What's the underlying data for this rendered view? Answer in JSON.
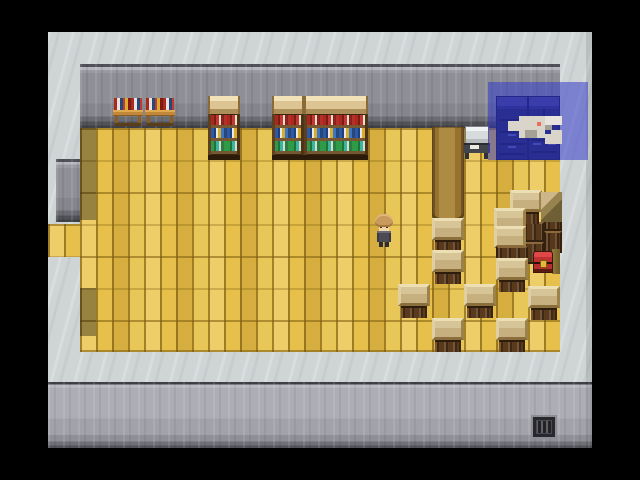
{
  "scene": {
    "title": "rpg-interior-library-storeroom",
    "viewport": {
      "x": 48,
      "y": 32,
      "w": 544,
      "h": 416
    },
    "palette": {
      "letterbox": "#000000",
      "ceiling": "#cfd4d5",
      "wall": "#96979e",
      "lower_wall": "#aaabb2",
      "floor": "#e6c04a",
      "selection_overlay": "rgba(47,53,201,0.52)",
      "crate_top": "#cdb88c",
      "crate_front": "#5a3a1c",
      "chest_red": "#c03232",
      "cabinet_navy": "#232759",
      "minimap_floor": "#d9d5cb",
      "player_marker": "#ef6e5a"
    },
    "regions": {
      "ceiling": [
        0,
        0,
        544,
        416
      ],
      "top_wall": [
        32,
        32,
        480,
        64
      ],
      "floor": [
        32,
        96,
        480,
        224
      ],
      "floor_edge": [
        32,
        318,
        480,
        2
      ],
      "alcove_wall": [
        8,
        127,
        24,
        63
      ],
      "alcove_floor": [
        0,
        192,
        32,
        33
      ],
      "lower_wall": [
        0,
        350,
        544,
        66
      ],
      "right_edge_shade": [
        538,
        0,
        6,
        416
      ],
      "shadows": [
        [
          32,
          96,
          16,
          92
        ],
        [
          32,
          256,
          16,
          48
        ]
      ]
    },
    "furniture": {
      "book_carts": [
        [
          65,
          66
        ],
        [
          97,
          66
        ]
      ],
      "bookshelves": [
        {
          "x": 160,
          "y": 64,
          "w": 32,
          "rows": [
            "red",
            "blue",
            "green"
          ]
        },
        {
          "x": 224,
          "y": 64,
          "w": 32,
          "rows": [
            "red",
            "blue",
            "green"
          ]
        },
        {
          "x": 256,
          "y": 64,
          "w": 64,
          "rows": [
            "red",
            "blue",
            "green"
          ]
        }
      ],
      "cabinets": {
        "x": 448,
        "y": 64,
        "w": 64,
        "h": 64
      },
      "counter": {
        "x": 415,
        "y": 94
      },
      "long_table": [
        384,
        95,
        32,
        96
      ],
      "grate": [
        485,
        385,
        22,
        20
      ]
    },
    "sprites": [
      [
        "dark",
        496,
        176,
        18,
        23
      ],
      [
        "dark",
        496,
        199,
        18,
        22
      ],
      [
        "dark",
        464,
        190,
        32,
        20
      ],
      [
        "dark",
        464,
        210,
        32,
        22
      ],
      [
        "crate",
        462,
        158
      ],
      [
        "crate",
        446,
        176
      ],
      [
        "crate",
        446,
        194
      ],
      [
        "dark",
        448,
        214,
        32,
        14
      ],
      [
        "wedge",
        493,
        160,
        21,
        30
      ],
      [
        "crate",
        384,
        186
      ],
      [
        "crate",
        384,
        218
      ],
      [
        "crate",
        448,
        226
      ],
      [
        "crate",
        350,
        252
      ],
      [
        "crate",
        416,
        252
      ],
      [
        "crate",
        480,
        254
      ],
      [
        "crate",
        384,
        286
      ],
      [
        "crate",
        448,
        286
      ],
      [
        "gold",
        504,
        217,
        8,
        25
      ],
      [
        "chest",
        485,
        219
      ]
    ],
    "player": {
      "x": 326,
      "y": 182,
      "facing": "down"
    },
    "map_overlay": {
      "rect": [
        440,
        50,
        100,
        78
      ],
      "minimap_origin": [
        459,
        82
      ],
      "minimap_blocks": [
        [
          12,
          2,
          26,
          22,
          "pale"
        ],
        [
          1,
          7,
          11,
          10,
          "pale"
        ],
        [
          38,
          2,
          17,
          9,
          "lighter"
        ],
        [
          44,
          16,
          11,
          14,
          "pale"
        ],
        [
          38,
          20,
          6,
          10,
          "pale"
        ],
        [
          38,
          11,
          7,
          5,
          "gray"
        ],
        [
          18,
          16,
          12,
          8,
          "gray"
        ],
        [
          30,
          8,
          4,
          4,
          "red"
        ]
      ]
    }
  }
}
